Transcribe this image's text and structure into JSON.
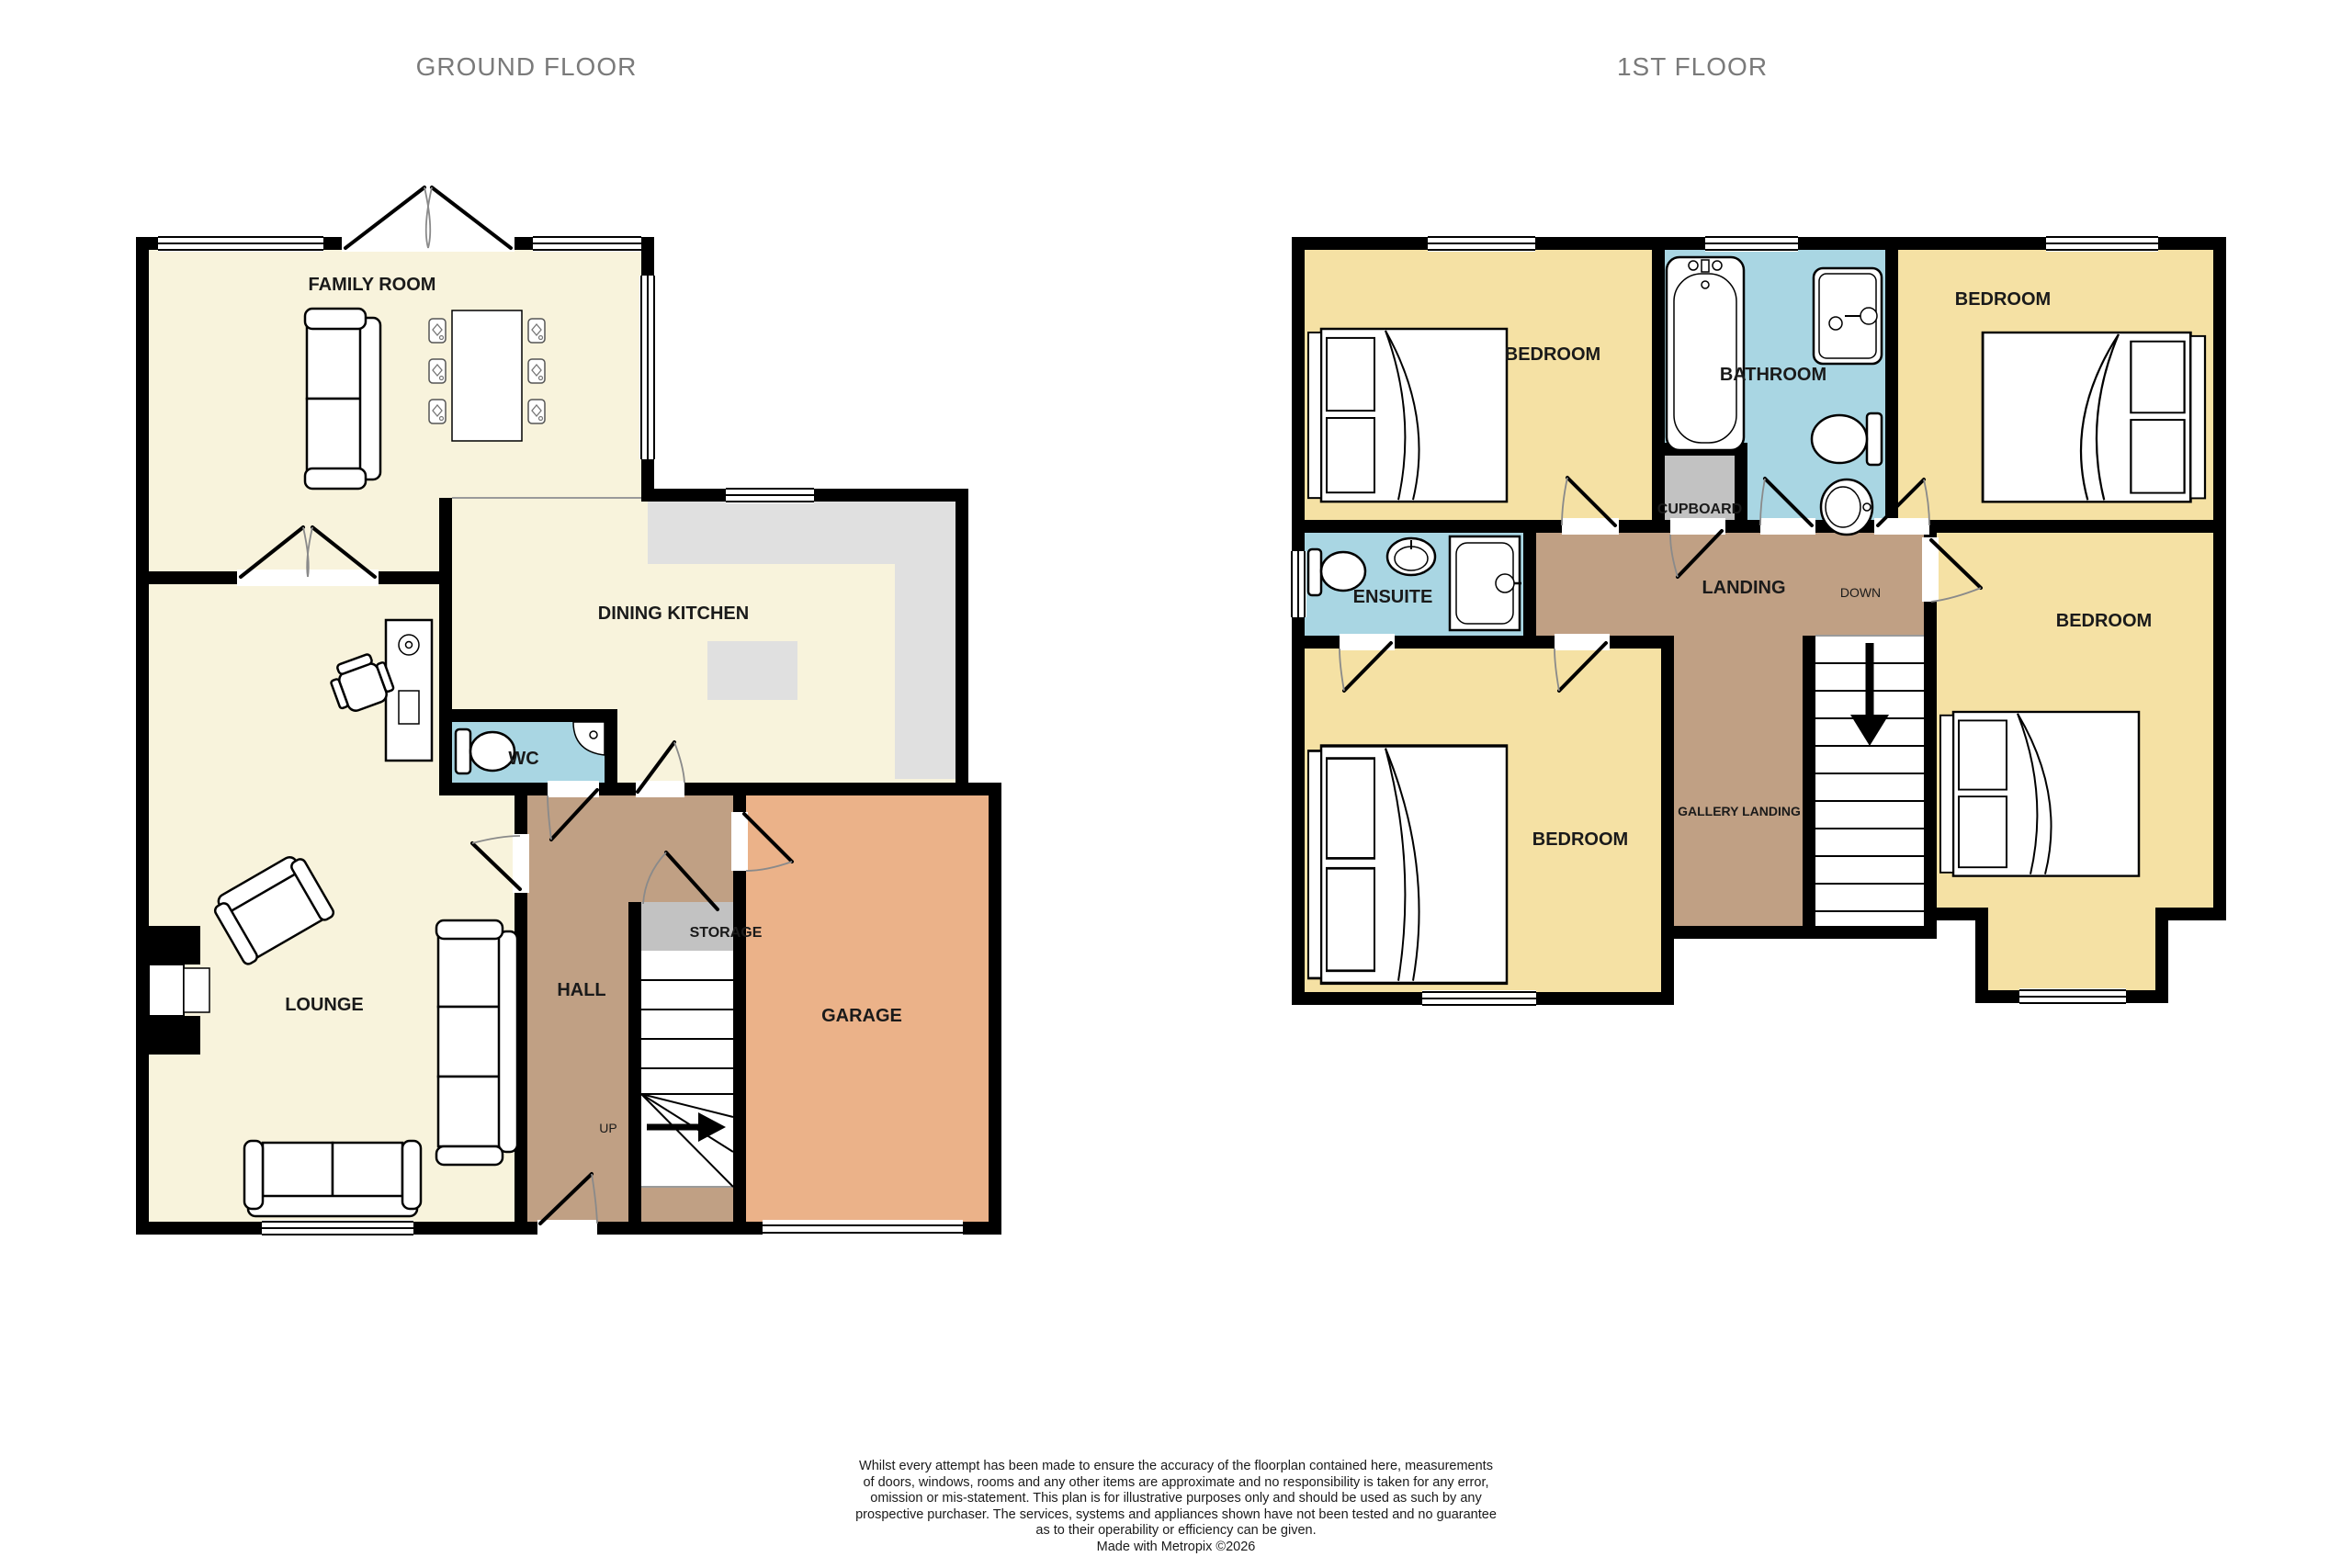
{
  "colors": {
    "wall": "#000000",
    "ground_floor_floor": "#F8F3DC",
    "first_floor_floor": "#F5E1A4",
    "wet_room_floor": "#A9D6E3",
    "hall_landing_floor": "#C0A084",
    "storage_cupboard_floor": "#C2C2C2",
    "kitchen_counter": "#E0E0E0",
    "garage_floor": "#EBB289",
    "title_text": "#7A7A7A",
    "label_text": "#1A1A1A"
  },
  "ground_floor": {
    "title": "GROUND FLOOR",
    "rooms": {
      "family_room": "FAMILY ROOM",
      "dining_kitchen": "DINING KITCHEN",
      "wc": "WC",
      "lounge": "LOUNGE",
      "hall": "HALL",
      "storage": "STORAGE",
      "garage": "GARAGE"
    },
    "stairs_direction_label": "UP"
  },
  "first_floor": {
    "title": "1ST FLOOR",
    "rooms": {
      "bedroom_top_left": "BEDROOM",
      "bathroom": "BATHROOM",
      "bedroom_top_right": "BEDROOM",
      "ensuite": "ENSUITE",
      "landing": "LANDING",
      "cupboard": "CUPBOARD",
      "gallery_landing": "GALLERY LANDING",
      "bedroom_bottom_left": "BEDROOM",
      "bedroom_right": "BEDROOM"
    },
    "stairs_direction_label": "DOWN"
  },
  "footer": {
    "lines": [
      "Whilst every attempt has been made to ensure the accuracy of the floorplan contained here, measurements",
      "of doors, windows, rooms and any other items are approximate and no responsibility is taken for any error,",
      "omission or mis-statement. This plan is for illustrative purposes only and should be used as such by any",
      "prospective purchaser. The services, systems and appliances shown have not been tested and no guarantee",
      "as to their operability or efficiency can be given.",
      "Made with Metropix ©2026"
    ]
  }
}
